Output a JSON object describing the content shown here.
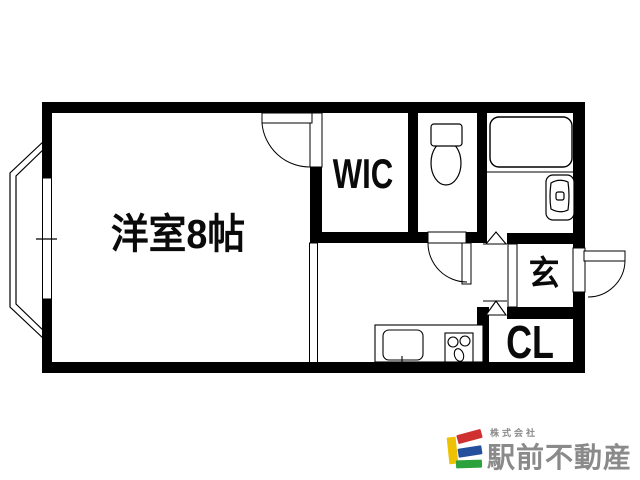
{
  "floor_plan": {
    "background": "#ffffff",
    "line_color": "#000000",
    "rooms": {
      "main_room": {
        "label": "洋室8帖"
      },
      "walk_in_closet": {
        "label": "WIC"
      },
      "entrance": {
        "label": "玄"
      },
      "closet": {
        "label": "CL"
      }
    },
    "fixtures": [
      "bay-window-icon",
      "toilet-icon",
      "bathtub-icon",
      "washbasin-icon",
      "kitchen-sink-icon",
      "stove-icon",
      "door-swing-icon",
      "folding-door-mark-icon"
    ]
  },
  "branding": {
    "company_prefix": "株式会社",
    "company_name": "駅前不動産",
    "logo_colors": {
      "yellow": "#edc204",
      "red": "#cf3130",
      "blue": "#234f9d",
      "green": "#2ba23c",
      "text_gray": "#8a8a8a"
    }
  }
}
